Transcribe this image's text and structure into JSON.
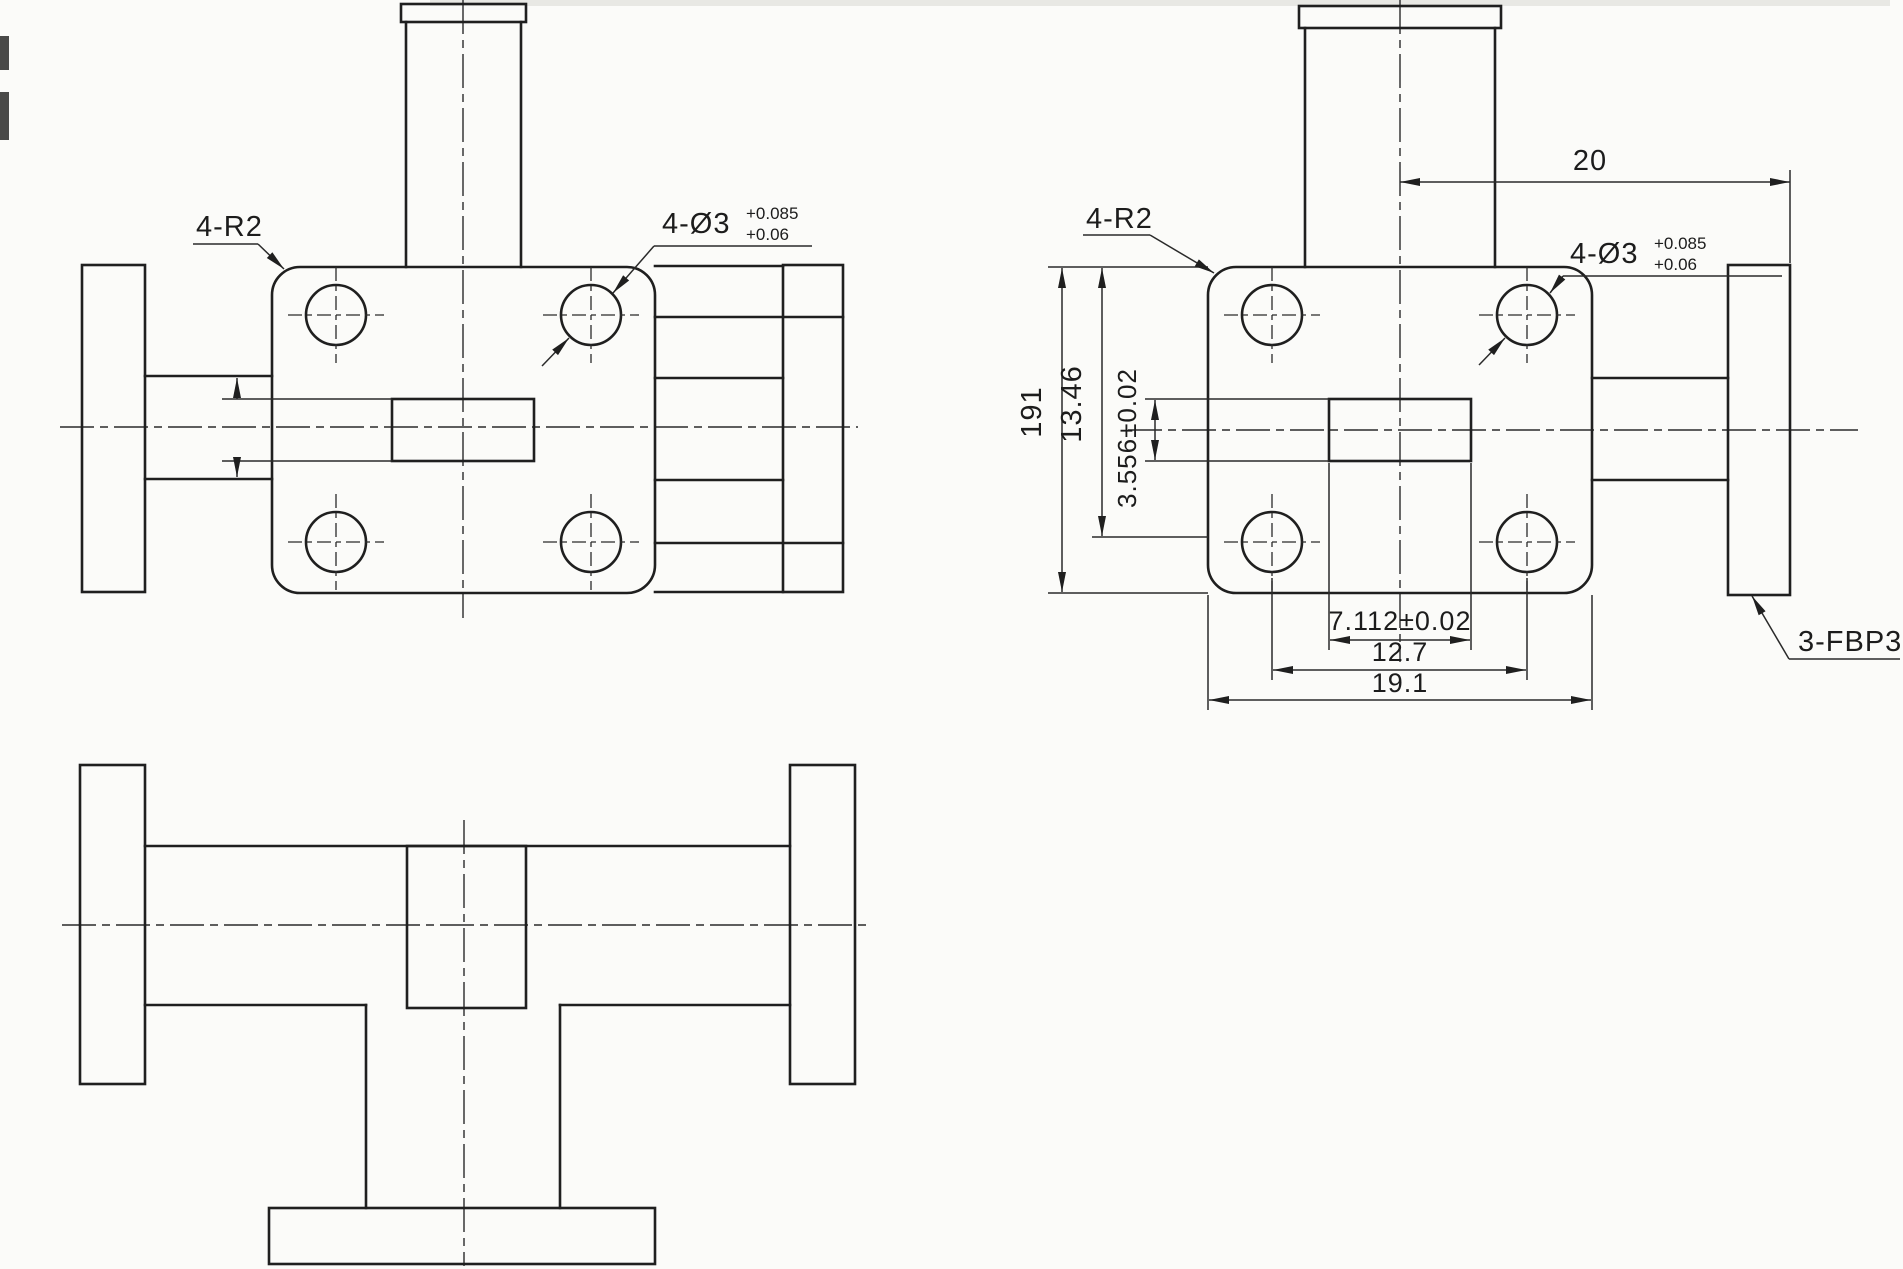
{
  "drawing": {
    "type": "engineering-drawing",
    "part": "waveguide-tee-three-views",
    "colors": {
      "ink": "#1f1f1f",
      "paper": "#fbfbf9"
    },
    "front_view": {
      "label_corner": "4-R2",
      "label_holes": "4-Ø3",
      "label_holes_tol_upper": "+0.085",
      "label_holes_tol_lower": "+0.06"
    },
    "side_view": {
      "label_corner": "4-R2",
      "label_holes": "4-Ø3",
      "label_holes_tol_upper": "+0.085",
      "label_holes_tol_lower": "+0.06",
      "label_flange": "3-FBP32",
      "dim_top_width": "20",
      "dim_plate_height": "191",
      "dim_hole_height": "13.46",
      "dim_aperture_height": "3.556±0.02",
      "dim_aperture_width": "7.112±0.02",
      "dim_hole_spacing": "12.7",
      "dim_plate_width": "19.1"
    }
  }
}
